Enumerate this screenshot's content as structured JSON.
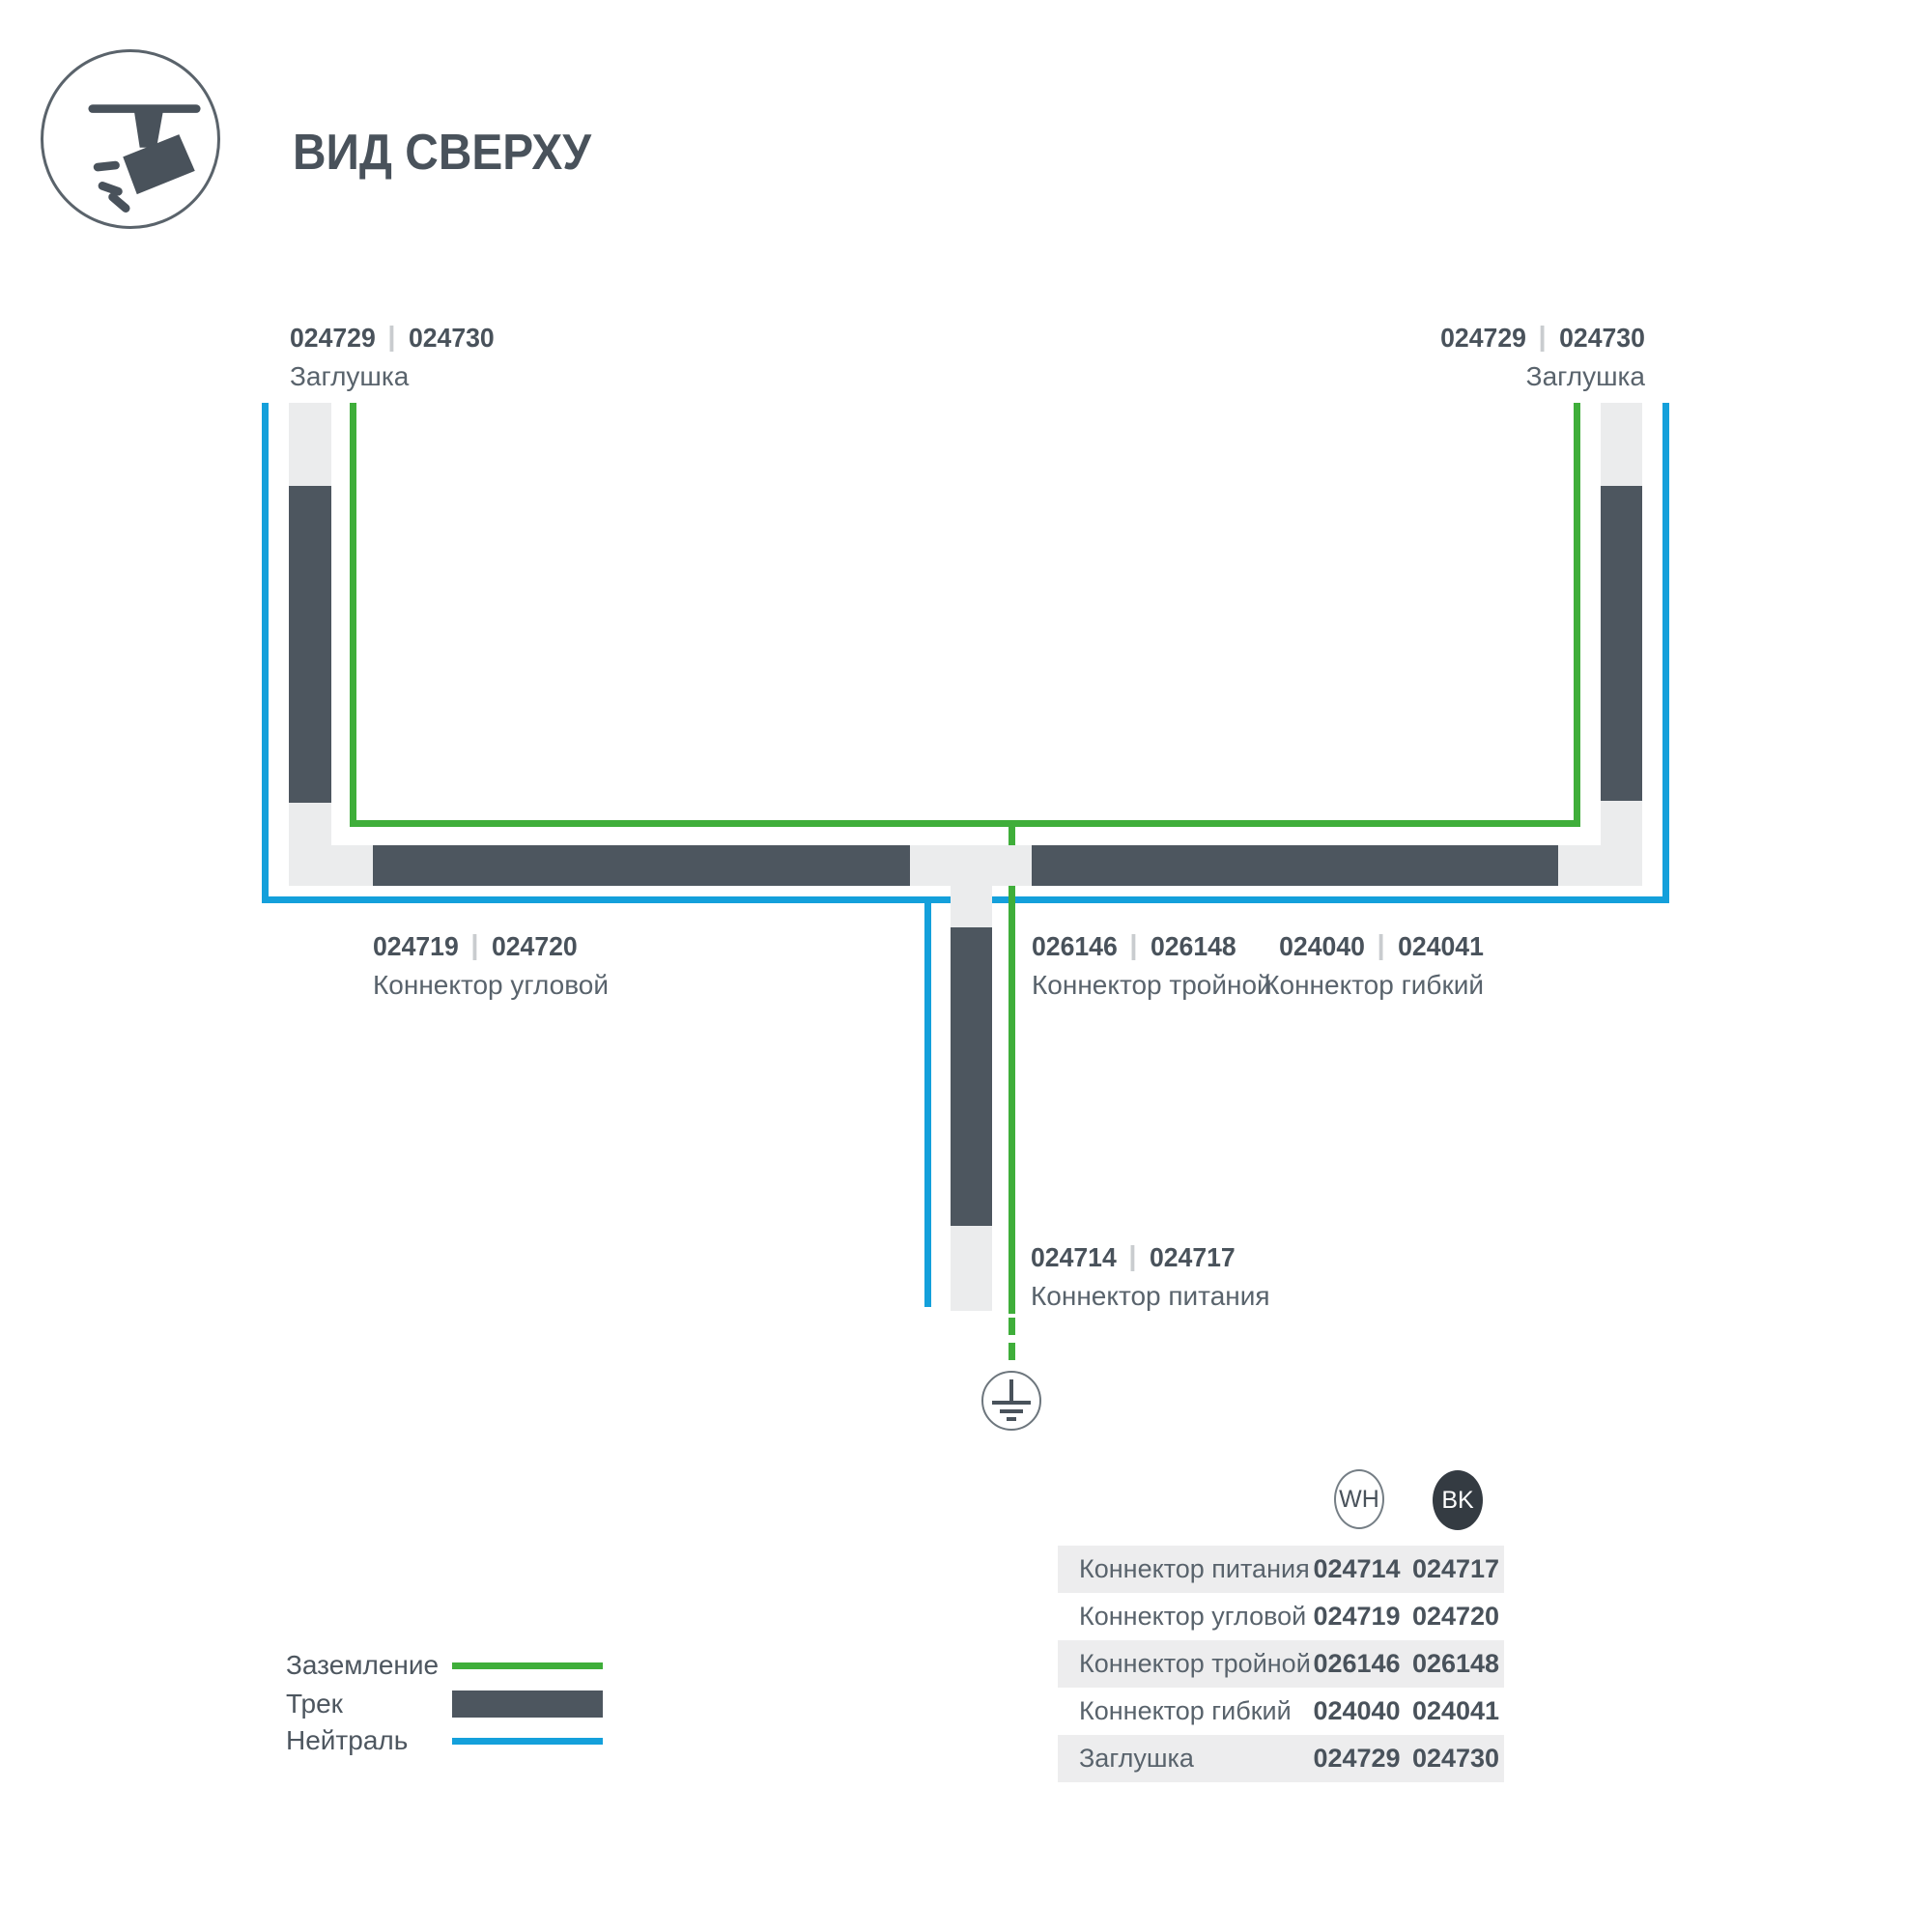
{
  "title": "ВИД СВЕРХУ",
  "view_icon": "top-view-track-spotlight",
  "labels": {
    "cap_left": {
      "wh": "024729",
      "bk": "024730",
      "name": "Заглушка"
    },
    "cap_right": {
      "wh": "024729",
      "bk": "024730",
      "name": "Заглушка"
    },
    "corner": {
      "wh": "024719",
      "bk": "024720",
      "name": "Коннектор угловой"
    },
    "triple": {
      "wh": "026146",
      "bk": "026148",
      "name": "Коннектор тройной"
    },
    "flex": {
      "wh": "024040",
      "bk": "024041",
      "name": "Коннектор гибкий"
    },
    "power": {
      "wh": "024714",
      "bk": "024717",
      "name": "Коннектор питания"
    }
  },
  "legend": {
    "ground": "Заземление",
    "track": "Трек",
    "neutral": "Нейтраль"
  },
  "table": {
    "col_wh": "WH",
    "col_bk": "BK",
    "rows": [
      {
        "name": "Коннектор питания",
        "wh": "024714",
        "bk": "024717"
      },
      {
        "name": "Коннектор угловой",
        "wh": "024719",
        "bk": "024720"
      },
      {
        "name": "Коннектор тройной",
        "wh": "026146",
        "bk": "026148"
      },
      {
        "name": "Коннектор гибкий",
        "wh": "024040",
        "bk": "024041"
      },
      {
        "name": "Заглушка",
        "wh": "024729",
        "bk": "024730"
      }
    ]
  },
  "colors": {
    "ground_green": "#3fae3a",
    "neutral_blue": "#14a0db",
    "track_dark": "#4d565f",
    "track_light": "#ebeced",
    "text_dark": "#49525b",
    "text_caption": "#59636c"
  }
}
